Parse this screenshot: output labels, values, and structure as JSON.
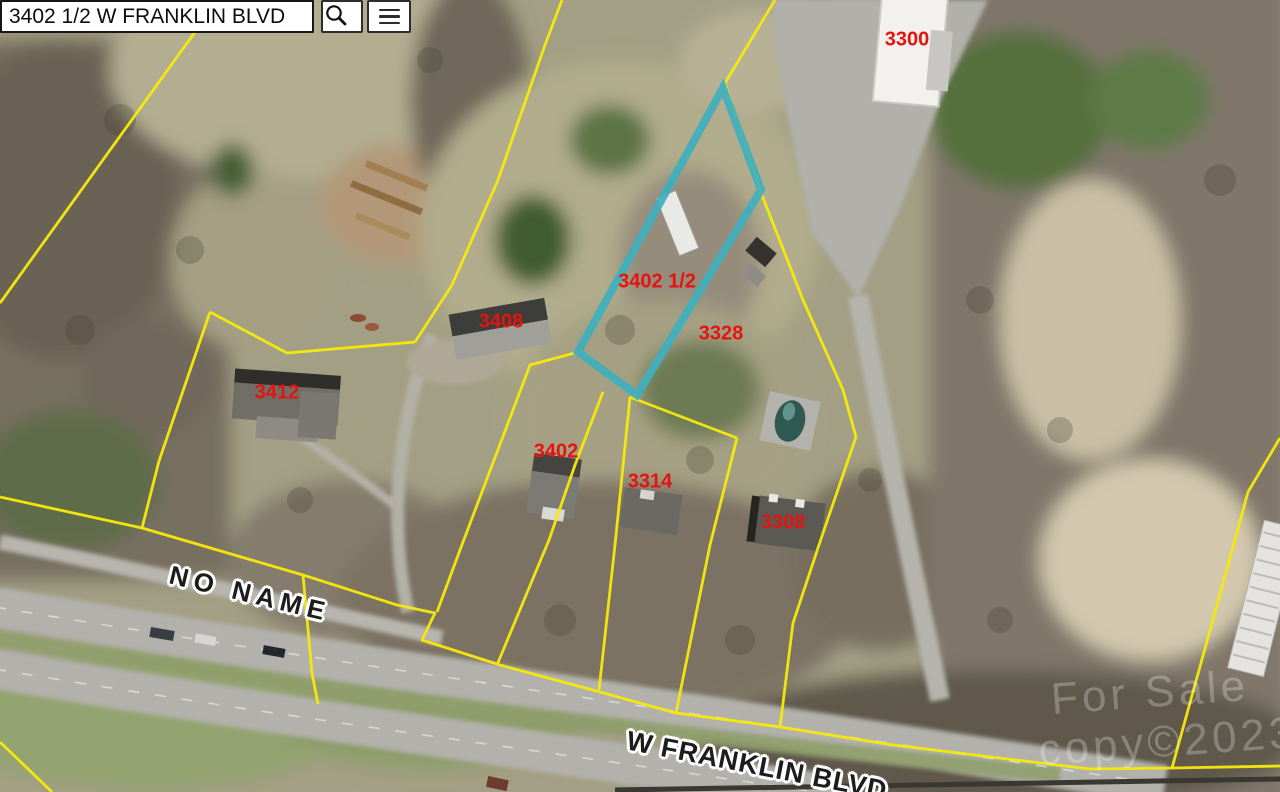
{
  "search": {
    "query": "3402 1/2 W FRANKLIN BLVD",
    "buttons": {
      "search": "search",
      "menu": "menu"
    }
  },
  "map": {
    "colors": {
      "highlight": "#3fafbc",
      "parcel_lines": "#f6e90b",
      "parcel_label": "#e41410",
      "road_label": "#1c1c1c"
    },
    "highlighted_parcel": "3402 1/2",
    "parcel_labels": [
      {
        "id": "3300",
        "x": 907,
        "y": 40
      },
      {
        "id": "3402 1/2",
        "x": 657,
        "y": 282
      },
      {
        "id": "3408",
        "x": 501,
        "y": 322
      },
      {
        "id": "3328",
        "x": 721,
        "y": 334
      },
      {
        "id": "3412",
        "x": 277,
        "y": 393
      },
      {
        "id": "3402",
        "x": 556,
        "y": 452
      },
      {
        "id": "3314",
        "x": 650,
        "y": 482
      },
      {
        "id": "3308",
        "x": 783,
        "y": 523
      }
    ],
    "road_labels": [
      {
        "id": "no-name",
        "text": "NO NAME",
        "x": 250,
        "y": 594,
        "rotation": 13.5,
        "font_size": 26,
        "letter_spacing": 6
      },
      {
        "id": "w-franklin-blvd",
        "text": "W FRANKLIN BLVD",
        "x": 757,
        "y": 766,
        "rotation": 11,
        "font_size": 27,
        "letter_spacing": 1
      }
    ],
    "watermark": [
      {
        "text": "For Sale",
        "x": 1150,
        "y": 693,
        "rotation": -4
      },
      {
        "text": "copy©2023",
        "x": 1168,
        "y": 742,
        "rotation": -4
      }
    ]
  }
}
